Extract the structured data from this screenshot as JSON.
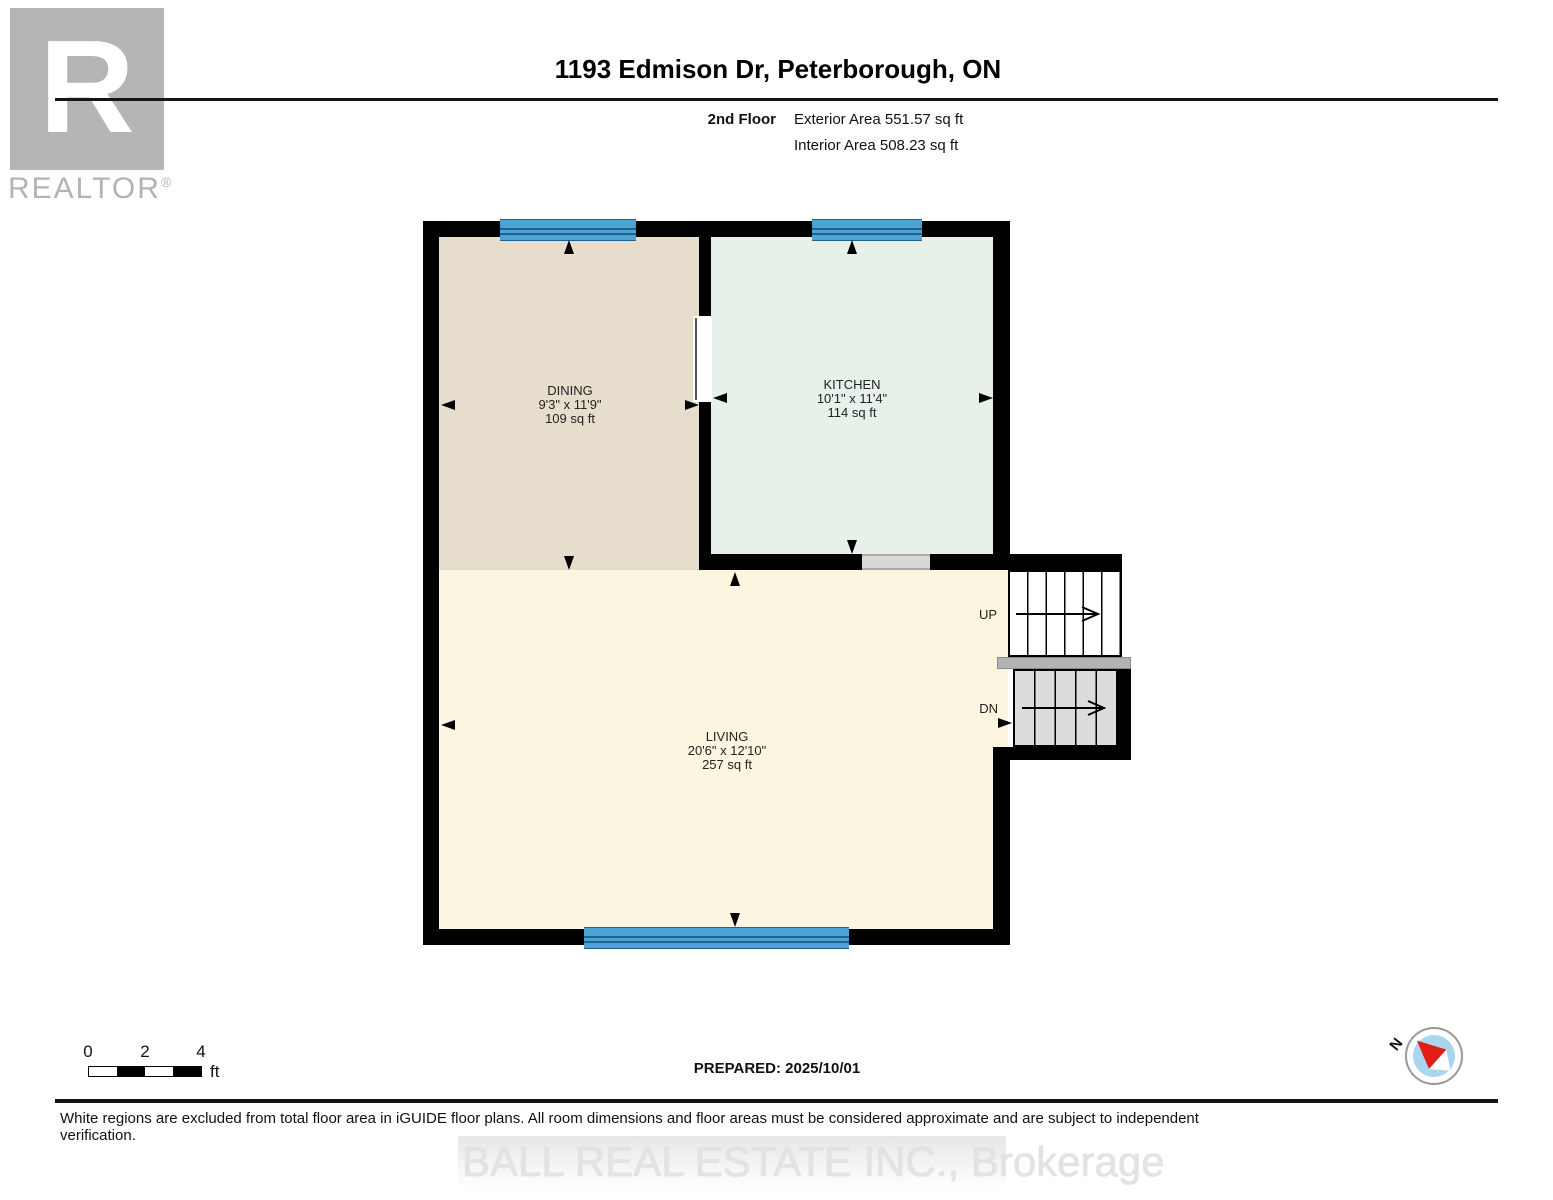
{
  "header": {
    "title": "1193 Edmison Dr, Peterborough, ON",
    "floor_label": "2nd Floor",
    "exterior_area": "Exterior Area 551.57 sq ft",
    "interior_area": "Interior Area 508.23 sq ft"
  },
  "logo": {
    "letter": "R",
    "brand": "REALTOR",
    "registered": "®"
  },
  "rooms": {
    "dining": {
      "name": "DINING",
      "dimensions": "9'3\" x 11'9\"",
      "area": "109 sq ft"
    },
    "kitchen": {
      "name": "KITCHEN",
      "dimensions": "10'1\" x 11'4\"",
      "area": "114 sq ft"
    },
    "living": {
      "name": "LIVING",
      "dimensions": "20'6\" x 12'10\"",
      "area": "257 sq ft"
    }
  },
  "stairs": {
    "up_label": "UP",
    "down_label": "DN"
  },
  "scale_bar": {
    "ticks": [
      "0",
      "2",
      "4"
    ],
    "unit": "ft"
  },
  "prepared_label": "PREPARED: 2025/10/01",
  "compass": {
    "north_label": "N"
  },
  "footer": {
    "disclaimer": "White regions are excluded from total floor area in iGUIDE floor plans. All room dimensions and floor areas must be considered approximate and are subject to independent verification."
  },
  "watermark": "BALL REAL ESTATE INC., Brokerage",
  "colors": {
    "wall": "#000000",
    "dining_fill": "#e6ddcd",
    "kitchen_fill": "#e7f0e9",
    "living_fill": "#fcf6e0",
    "window_blue": "#4da3d5",
    "stairs_down_fill": "#dcdcdc",
    "landing_gray": "#b3b3b3",
    "door_opening_gray": "#d8d8d8",
    "logo_gray": "#b5b5b5",
    "compass_needle_red": "#e51c15",
    "compass_inner_blue": "#a9d6ee"
  }
}
